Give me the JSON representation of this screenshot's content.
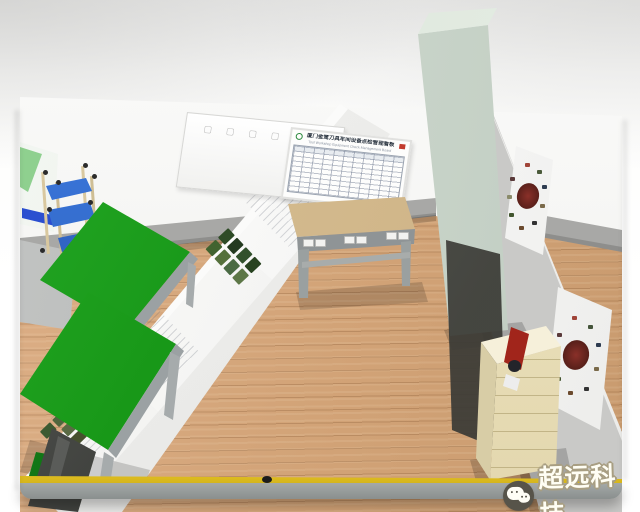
{
  "watermark": {
    "label": "超远科技",
    "icon": "wechat-logo"
  },
  "kanban_board": {
    "title": "厦门金鹭刀具车间设备点检管理看板",
    "subtitle": "Tool Workshop Equipment Check Management Board",
    "logo_icon": "green-globe-logo",
    "corner_mark_color": "#c23b2e",
    "grid": {
      "columns": 12,
      "rows": 10
    }
  },
  "plain_whiteboard": {
    "stamps": [
      "▢",
      "▢",
      "▢",
      "▢"
    ]
  },
  "room": {
    "floor_marking_color": "#f2d32c",
    "workbench_count_green": 2,
    "poster_count_right_wall": 2,
    "objects": [
      "plain-whiteboard",
      "management-kanban-board",
      "concrete-pillar",
      "center-workbench",
      "green-workbench-far",
      "green-workbench-near",
      "sop-display-boards",
      "radial-photo-posters",
      "supply-cabinet",
      "fire-extinguisher",
      "pipe-rack-cart",
      "display-panel",
      "storage-cabinets",
      "yellow-floor-line"
    ]
  },
  "colors": {
    "background_top": "#e9e9e8",
    "wood_floor": "#d6a87d",
    "wall_white": "#f6f6f4",
    "wall_gray": "#d6d6d4",
    "baseboard_gray": "#a5a5a3",
    "bench_green": "#1f9b1f",
    "cabinet_cream": "#ece3c2",
    "extinguisher_red": "#c03024",
    "cart_blue": "#2f6fd0",
    "cart_pipe_tan": "#d8c79e",
    "line_yellow": "#f2d32c"
  }
}
